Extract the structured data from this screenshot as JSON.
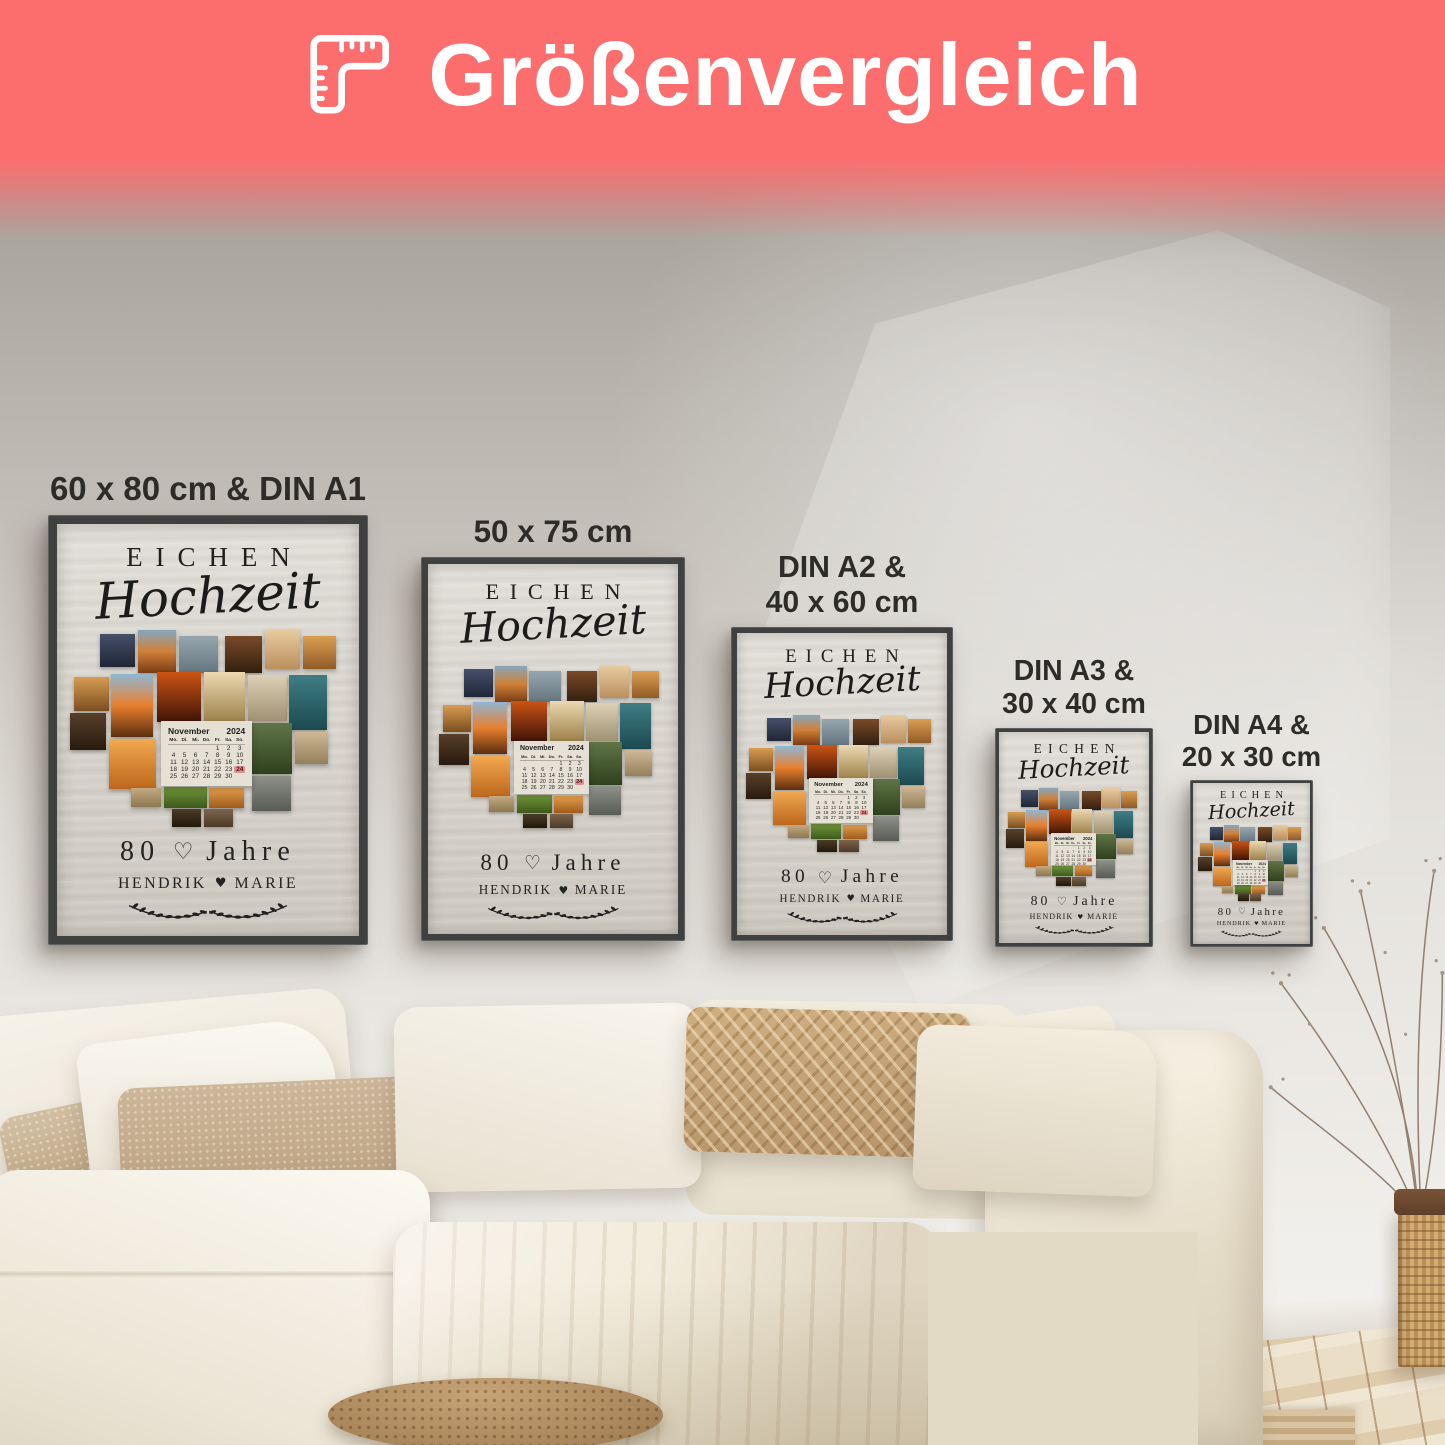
{
  "header": {
    "title": "Größenvergleich",
    "icon": "ruler-icon",
    "bg_color": "#fc6d6d",
    "text_color": "#ffffff"
  },
  "posters": [
    {
      "label_lines": [
        "60 x 80 cm & DIN A1"
      ],
      "left": 48,
      "top": 515,
      "width": 320,
      "height": 430
    },
    {
      "label_lines": [
        "50 x 75 cm"
      ],
      "left": 421,
      "top": 557,
      "width": 264,
      "height": 384
    },
    {
      "label_lines": [
        "DIN A2 &",
        "40 x 60 cm"
      ],
      "left": 731,
      "top": 627,
      "width": 222,
      "height": 314
    },
    {
      "label_lines": [
        "DIN A3 &",
        "30 x 40 cm"
      ],
      "left": 995,
      "top": 728,
      "width": 158,
      "height": 219
    },
    {
      "label_lines": [
        "DIN A4 &",
        "20 x 30 cm"
      ],
      "left": 1190,
      "top": 780,
      "width": 123,
      "height": 167
    }
  ],
  "poster_design": {
    "title": "EICHEN",
    "subtitle": "Hochzeit",
    "years_number": "80",
    "years_heart": "♡",
    "years_label": "Jahre",
    "name_left": "HENDRIK",
    "name_heart": "♥",
    "name_right": "MARIE",
    "frame_color": "#3e4140",
    "calendar_box": {
      "x": 33,
      "y": 46,
      "w": 33,
      "h": 33
    },
    "calendar": {
      "month": "November",
      "year": "2024",
      "day_headers": [
        "Mo.",
        "Di.",
        "Mi.",
        "Do.",
        "Fr.",
        "Sa.",
        "So."
      ],
      "weeks": [
        [
          "",
          "",
          "",
          "",
          "1",
          "2",
          "3"
        ],
        [
          "4",
          "5",
          "6",
          "7",
          "8",
          "9",
          "10"
        ],
        [
          "11",
          "12",
          "13",
          "14",
          "15",
          "16",
          "17"
        ],
        [
          "18",
          "19",
          "20",
          "21",
          "22",
          "23",
          "24"
        ],
        [
          "25",
          "26",
          "27",
          "28",
          "29",
          "30",
          ""
        ]
      ],
      "highlight_day": "24",
      "highlight_color": "#dc9090"
    },
    "collage_tiles": [
      {
        "x": 11,
        "y": 2,
        "w": 12.5,
        "h": 17,
        "colors": [
          "#46506a",
          "#1f2636"
        ]
      },
      {
        "x": 24.5,
        "y": 0,
        "w": 14,
        "h": 22,
        "colors": [
          "#86a7bd",
          "#d08038",
          "#7a3d14"
        ]
      },
      {
        "x": 39.5,
        "y": 3,
        "w": 14,
        "h": 19,
        "colors": [
          "#97a6ae",
          "#64757f"
        ]
      },
      {
        "x": 56,
        "y": 3,
        "w": 13.5,
        "h": 19,
        "colors": [
          "#7a4a28",
          "#33200f"
        ]
      },
      {
        "x": 70.5,
        "y": 0,
        "w": 13,
        "h": 20,
        "colors": [
          "#e7cba0",
          "#bb8f5e"
        ]
      },
      {
        "x": 84.5,
        "y": 3,
        "w": 12,
        "h": 17,
        "colors": [
          "#dc9e52",
          "#8f5c26"
        ]
      },
      {
        "x": 1.5,
        "y": 24,
        "w": 12.5,
        "h": 17,
        "colors": [
          "#d89c52",
          "#7c4f20"
        ]
      },
      {
        "x": 15,
        "y": 22.5,
        "w": 15,
        "h": 32,
        "colors": [
          "#90b6d4",
          "#e87f2e",
          "#5c2e0f"
        ]
      },
      {
        "x": 31.5,
        "y": 21.5,
        "w": 16,
        "h": 25,
        "colors": [
          "#cc5414",
          "#401408"
        ]
      },
      {
        "x": 48.5,
        "y": 21.5,
        "w": 15,
        "h": 25,
        "colors": [
          "#ecd9b2",
          "#9c8148"
        ]
      },
      {
        "x": 64.5,
        "y": 23,
        "w": 14,
        "h": 23,
        "colors": [
          "#dcd0b6",
          "#a09172"
        ]
      },
      {
        "x": 79.5,
        "y": 23,
        "w": 13.5,
        "h": 28,
        "colors": [
          "#3f7d84",
          "#1c4a50"
        ]
      },
      {
        "x": 0,
        "y": 42,
        "w": 13,
        "h": 19,
        "colors": [
          "#57402a",
          "#281a0e"
        ]
      },
      {
        "x": 14,
        "y": 55.5,
        "w": 17,
        "h": 25,
        "colors": [
          "#f2a850",
          "#bd671c"
        ]
      },
      {
        "x": 66,
        "y": 47,
        "w": 14.5,
        "h": 26,
        "colors": [
          "#5f7546",
          "#2f401d"
        ]
      },
      {
        "x": 81.5,
        "y": 52,
        "w": 12,
        "h": 16,
        "colors": [
          "#cfb896",
          "#938059"
        ]
      },
      {
        "x": 66,
        "y": 74,
        "w": 14,
        "h": 18,
        "colors": [
          "#8e9189",
          "#595c55"
        ]
      },
      {
        "x": 22,
        "y": 80,
        "w": 11,
        "h": 10,
        "colors": [
          "#c2aa80",
          "#8d7850"
        ]
      },
      {
        "x": 34,
        "y": 79.5,
        "w": 15.5,
        "h": 11,
        "colors": [
          "#6f9539",
          "#3e5a1c"
        ]
      },
      {
        "x": 50.5,
        "y": 80,
        "w": 12.5,
        "h": 10.5,
        "colors": [
          "#e19c4c",
          "#a05c1c"
        ]
      },
      {
        "x": 37,
        "y": 91,
        "w": 10.5,
        "h": 9,
        "colors": [
          "#4c3c28",
          "#211809"
        ]
      },
      {
        "x": 48.5,
        "y": 91,
        "w": 10.5,
        "h": 9,
        "colors": [
          "#7c644a",
          "#4c3a28"
        ]
      }
    ]
  },
  "palette": {
    "banner": "#fc6d6d",
    "wall_top": "#a5a099",
    "wall_bottom": "#efede9",
    "sofa_cream": "#f2ecdf",
    "pillow_beige": "#c8b295",
    "pouf_brown": "#ad8a5e",
    "floor_wood": "#e4d3b4",
    "basket_rattan": "#cda571"
  }
}
